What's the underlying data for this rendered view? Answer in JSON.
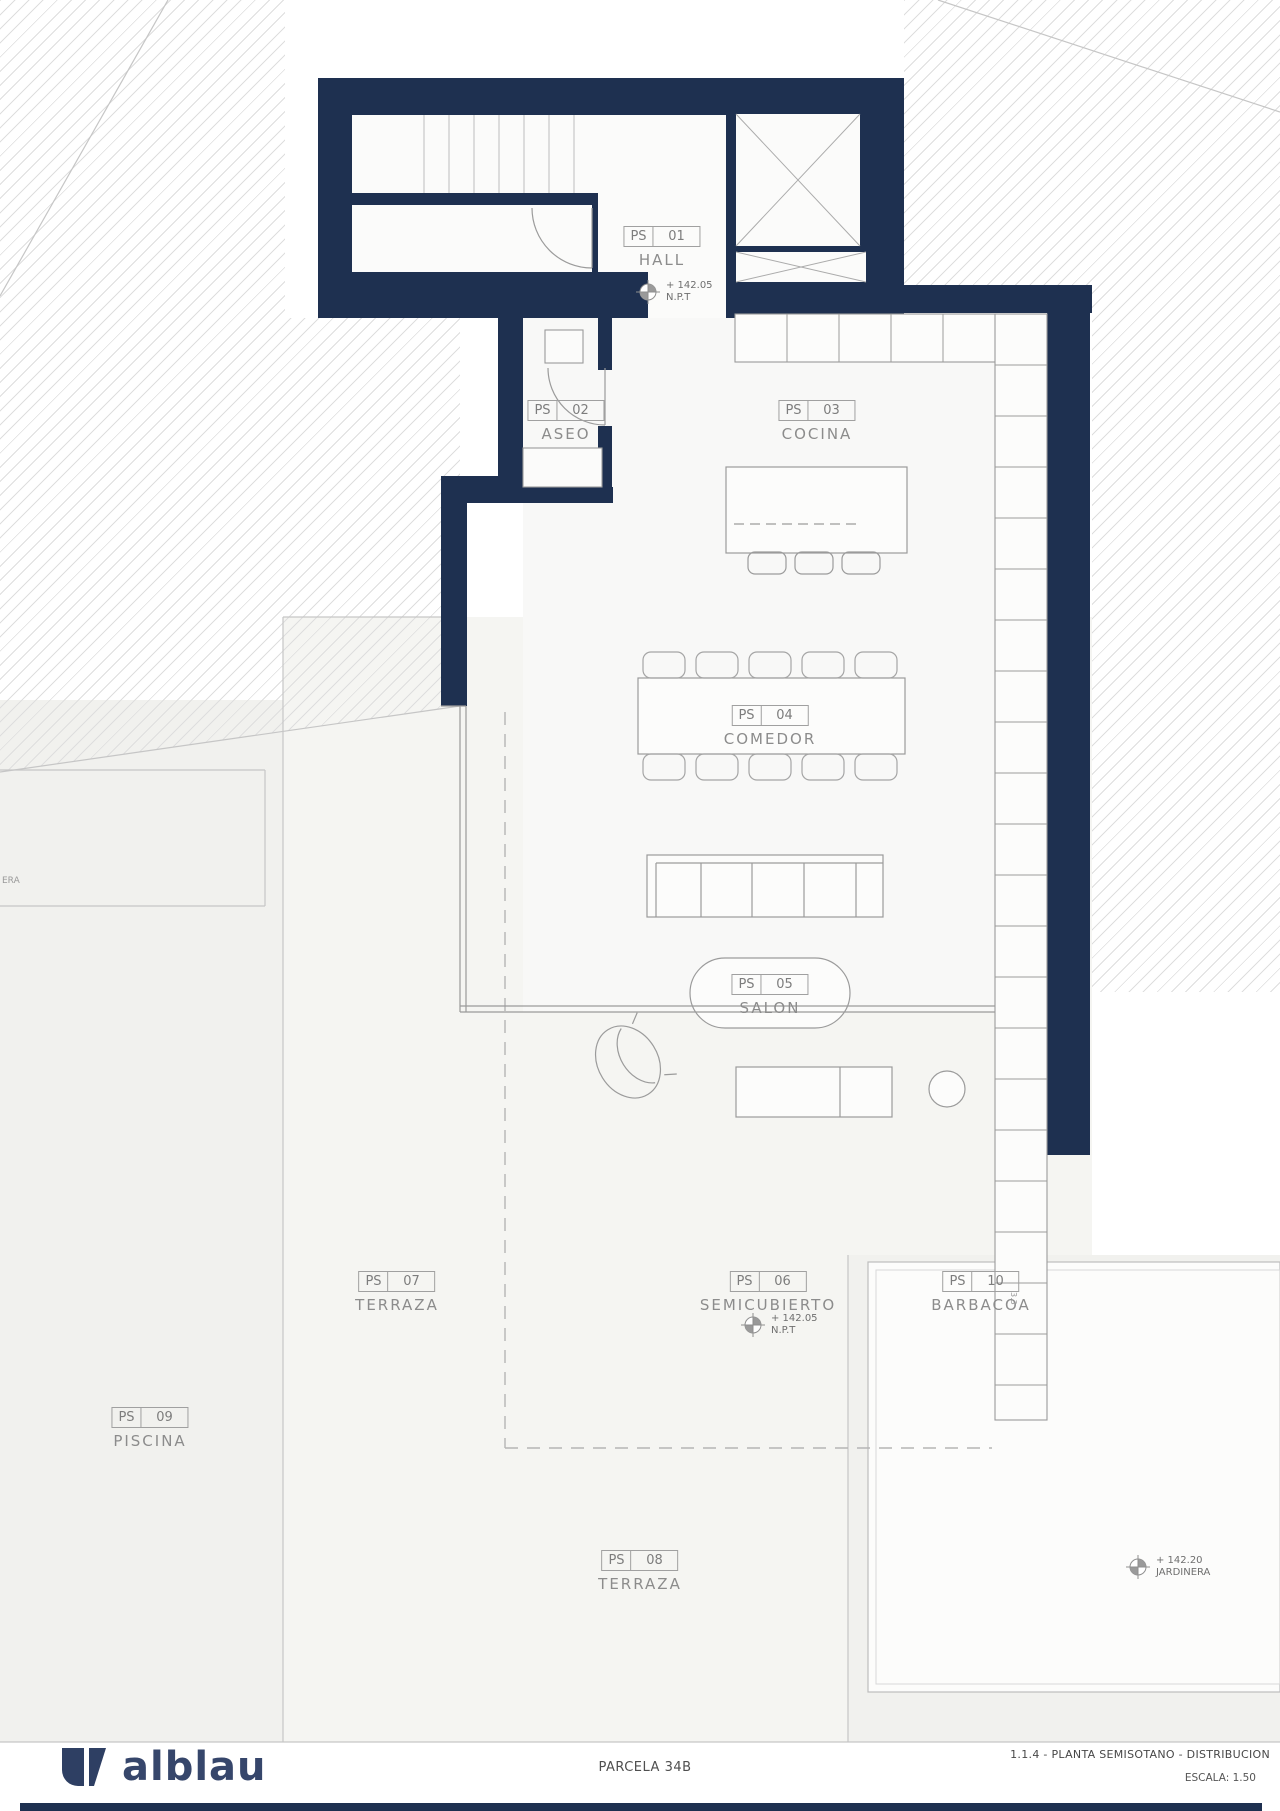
{
  "document": {
    "logo_text": "alblau",
    "parcel_label": "PARCELA 34B",
    "sheet_title": "1.1.4 - PLANTA SEMISOTANO -  DISTRIBUCION",
    "scale_label": "ESCALA: 1.50"
  },
  "plan": {
    "rooms": [
      {
        "code": "PS",
        "num": "01",
        "name": "HALL"
      },
      {
        "code": "PS",
        "num": "02",
        "name": "ASEO"
      },
      {
        "code": "PS",
        "num": "03",
        "name": "COCINA"
      },
      {
        "code": "PS",
        "num": "04",
        "name": "COMEDOR"
      },
      {
        "code": "PS",
        "num": "05",
        "name": "SALON"
      },
      {
        "code": "PS",
        "num": "06",
        "name": "SEMICUBIERTO"
      },
      {
        "code": "PS",
        "num": "07",
        "name": "TERRAZA"
      },
      {
        "code": "PS",
        "num": "08",
        "name": "TERRAZA"
      },
      {
        "code": "PS",
        "num": "09",
        "name": "PISCINA"
      },
      {
        "code": "PS",
        "num": "10",
        "name": "BARBACOA"
      }
    ],
    "level_markers": [
      {
        "value": "+ 142.05",
        "label": "N.P.T"
      },
      {
        "value": "+ 142.05",
        "label": "N.P.T"
      },
      {
        "value": "+ 142.20",
        "label": "JARDINERA"
      }
    ],
    "annotations": {
      "clipped_left_text": "ERA",
      "rotated_dim_text": "3.3"
    }
  },
  "colors": {
    "wall_navy": "#1e3050",
    "logo_navy": "#36466b",
    "floor": "#f8f8f7",
    "terrain": "#f1f1ee",
    "line_gray": "#9b9b9b",
    "label_gray": "#8c8c8c"
  }
}
